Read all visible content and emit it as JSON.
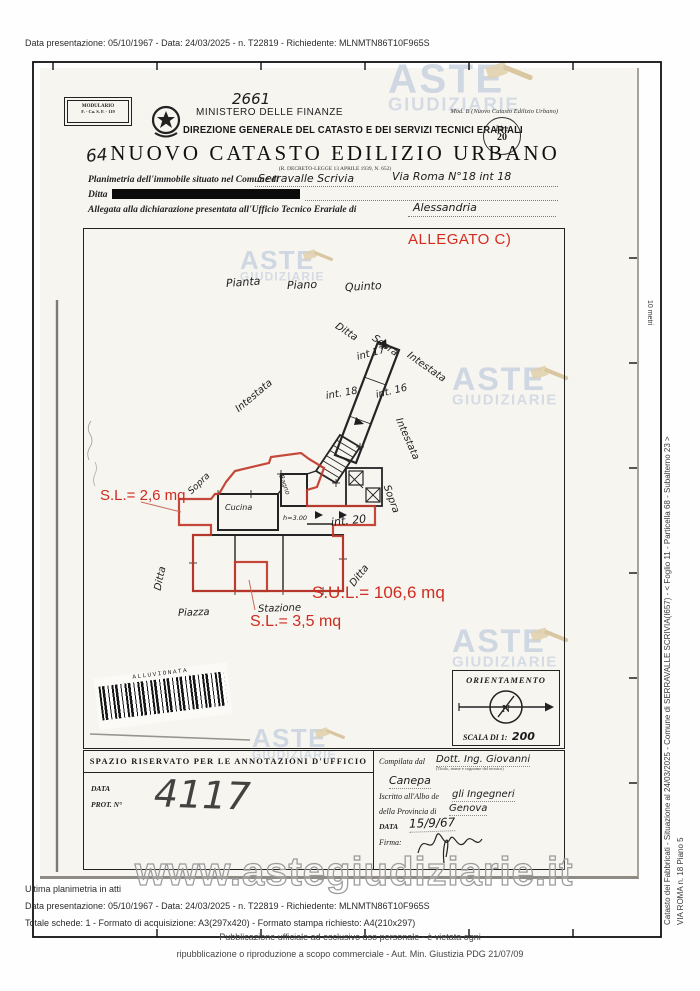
{
  "meta_top": "Data presentazione: 05/10/1967 - Data: 24/03/2025 - n. T22819 - Richiedente: MLNMTN86T10F965S",
  "side": {
    "line1": "Catasto dei Fabbricati - Situazione al 24/03/2025 - Comune di SERRAVALLE SCRIVIA(I657) - <  Foglio 11 - Particella 68 - Subalterno 23 >",
    "line2": "VIA ROMA n. 18 Piano 5",
    "ruler": "10 metri"
  },
  "header": {
    "modulario_line1": "MODULARIO",
    "modulario_line2": "F. - Ca. S. F. - 119",
    "hand_number": "2661",
    "hand_number_left": "64",
    "ministry": "MINISTERO DELLE FINANZE",
    "directorate": "DIREZIONE GENERALE DEL CATASTO E DEI SERVIZI TECNICI ERARIALI",
    "mod_b": "Mod. B (Nuovo Catasto Edilizio Urbano)",
    "stamp_line1": "Lire",
    "stamp_line2": "20",
    "title": "NUOVO CATASTO EDILIZIO URBANO",
    "law": "(R. DECRETO-LEGGE 13 APRILE 1939, N. 652)"
  },
  "form": {
    "line1_label": "Planimetria dell'immobile situato nel Comune di",
    "line1_value": "Serravalle Scrivia",
    "line1_value2": "Via Roma N°18 int 18",
    "ditta_label": "Ditta",
    "line3_label": "Allegata alla dichiarazione presentata all'Ufficio Tecnico Erariale di",
    "line3_value": "Alessandria"
  },
  "plan": {
    "allegato": "ALLEGATO C)",
    "labels": [
      {
        "text": "Pianta",
        "x": 226,
        "y": 277,
        "r": -4,
        "fs": 11
      },
      {
        "text": "Piano",
        "x": 287,
        "y": 279,
        "r": -2,
        "fs": 11
      },
      {
        "text": "Quinto",
        "x": 345,
        "y": 281,
        "r": -3,
        "fs": 11
      },
      {
        "text": "Ditta",
        "x": 336,
        "y": 320,
        "r": 33,
        "fs": 10
      },
      {
        "text": "Sopra",
        "x": 373,
        "y": 332,
        "r": 35,
        "fs": 10
      },
      {
        "text": "Intestata",
        "x": 408,
        "y": 349,
        "r": 35,
        "fs": 10
      },
      {
        "text": "int 17",
        "x": 357,
        "y": 352,
        "r": -15,
        "fs": 10
      },
      {
        "text": "Intestata",
        "x": 237,
        "y": 405,
        "r": -40,
        "fs": 10
      },
      {
        "text": "int. 18",
        "x": 326,
        "y": 391,
        "r": -10,
        "fs": 10
      },
      {
        "text": "int. 16",
        "x": 376,
        "y": 390,
        "r": -14,
        "fs": 10
      },
      {
        "text": "Intestata",
        "x": 398,
        "y": 413,
        "r": 66,
        "fs": 10
      },
      {
        "text": "Sopra",
        "x": 190,
        "y": 488,
        "r": -44,
        "fs": 9
      },
      {
        "text": "Bagno",
        "x": 281,
        "y": 471,
        "r": 70,
        "fs": 6.5
      },
      {
        "text": "Cucina",
        "x": 225,
        "y": 503,
        "r": 0,
        "fs": 8
      },
      {
        "text": "h=3.00",
        "x": 283,
        "y": 514,
        "r": 0,
        "fs": 6.5
      },
      {
        "text": "int. 20",
        "x": 331,
        "y": 516,
        "r": -6,
        "fs": 11
      },
      {
        "text": "Sopra",
        "x": 386,
        "y": 480,
        "r": 70,
        "fs": 10
      },
      {
        "text": "Ditta",
        "x": 158,
        "y": 585,
        "r": -78,
        "fs": 10
      },
      {
        "text": "Ditta",
        "x": 352,
        "y": 580,
        "r": -52,
        "fs": 10
      },
      {
        "text": "Piazza",
        "x": 178,
        "y": 608,
        "r": -2,
        "fs": 10
      },
      {
        "text": "Stazione",
        "x": 258,
        "y": 604,
        "r": -2,
        "fs": 10
      }
    ],
    "red_annotations": [
      {
        "text": "S.L.= 2,6 mq",
        "x": 100,
        "y": 487,
        "fs": 15
      },
      {
        "text": "S.U.L.= 106,6 mq",
        "x": 312,
        "y": 583,
        "fs": 17
      },
      {
        "text": "S.L.= 3,5 mq",
        "x": 250,
        "y": 613,
        "fs": 16
      }
    ],
    "barcode_text": "ALLUVIONATA",
    "orientamento": "ORIENTAMENTO",
    "scala_label": "SCALA DI 1:",
    "scala_value": "200",
    "compass_n": "N"
  },
  "office": {
    "header": "SPAZIO RISERVATO PER LE ANNOTAZIONI D'UFFICIO",
    "data_label": "DATA",
    "prot_label": "PROT. N°",
    "prot_hand": "4117",
    "compilata_label": "Compilata dal",
    "compilata_hand": "Dott. Ing. Giovanni",
    "compilata_hand2": "Canepa",
    "compilata_sub": "(Titolo, nome e cognome del tecnico)",
    "albo_label": "Iscritto all'Albo de",
    "albo_hand": "gli Ingegneri",
    "provincia_label": "della Provincia di",
    "provincia_hand": "Genova",
    "data2_label": "DATA",
    "data2_hand": "15/9/67",
    "firma_label": "Firma:"
  },
  "footer": {
    "line1": "Ultima planimetria in atti",
    "line2": "Data presentazione: 05/10/1967 - Data: 24/03/2025 - n. T22819 - Richiedente: MLNMTN86T10F965S",
    "line3": "Totale schede: 1 - Formato di acquisizione: A3(297x420)  - Formato stampa richiesto: A4(210x297)",
    "notice1": "Pubblicazione ufficiale ad esclusivo uso personale - è vietata ogni",
    "notice2": "ripubblicazione o riproduzione a scopo commerciale - Aut. Min. Giustizia PDG 21/07/09",
    "url_watermark": "www.astegiudiziarie.it"
  },
  "watermark": {
    "word1": "ASTE",
    "word2": "GIUDIZIARIE"
  },
  "watermarks": [
    {
      "x": 388,
      "y": 60,
      "s": 1.12
    },
    {
      "x": 240,
      "y": 248,
      "s": 0.72
    },
    {
      "x": 452,
      "y": 364,
      "s": 0.9
    },
    {
      "x": 452,
      "y": 626,
      "s": 0.9
    },
    {
      "x": 252,
      "y": 726,
      "s": 0.72
    }
  ]
}
